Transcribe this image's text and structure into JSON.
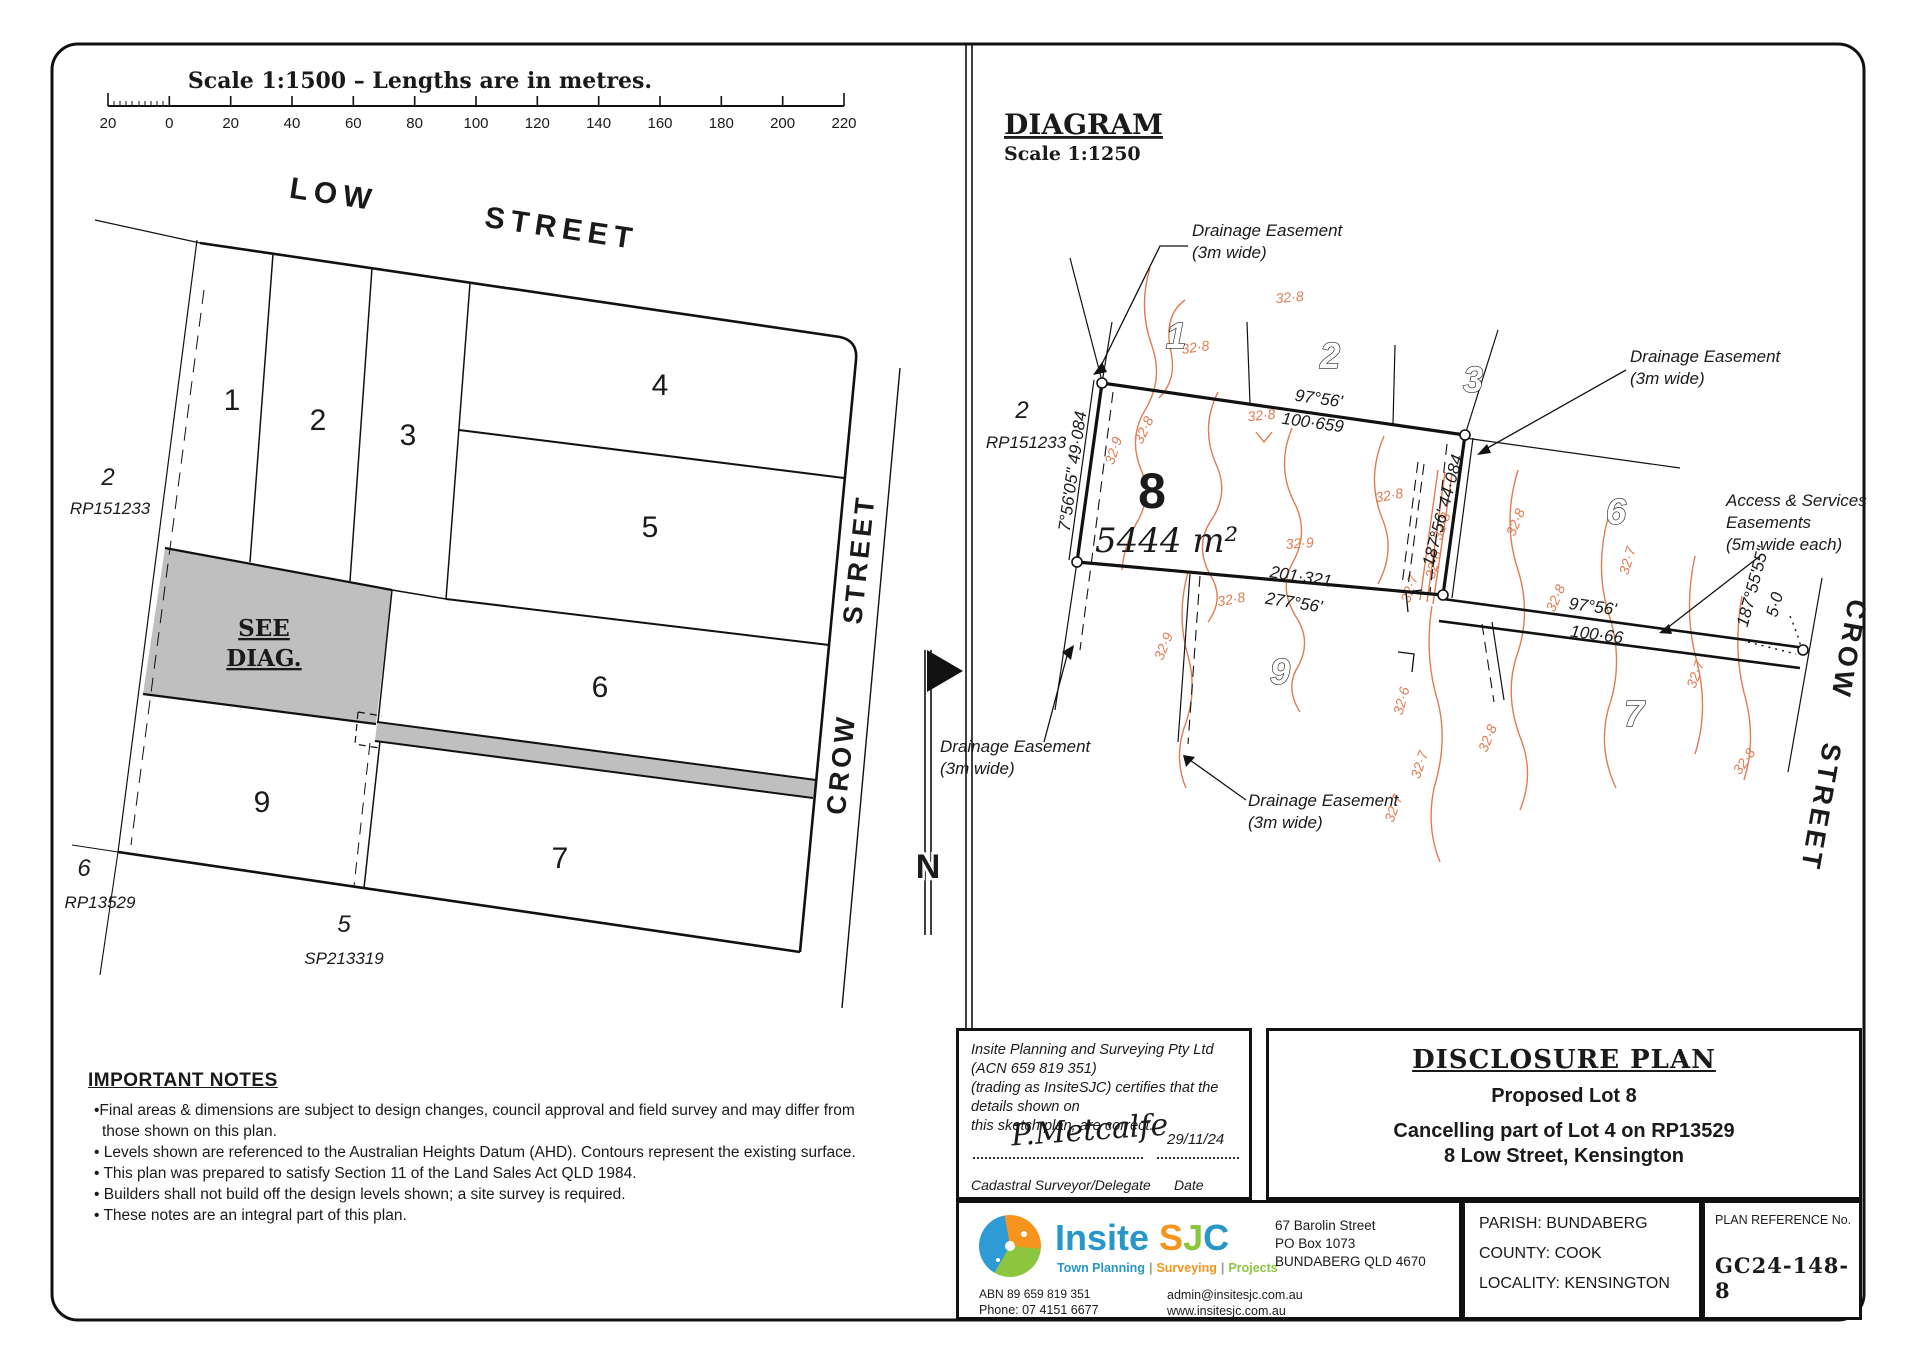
{
  "scale_bar": {
    "title": "Scale 1:1500 – Lengths are in metres.",
    "ticks": [
      "20",
      "0",
      "20",
      "40",
      "60",
      "80",
      "100",
      "120",
      "140",
      "160",
      "180",
      "200",
      "220"
    ]
  },
  "overview": {
    "low_street": {
      "w1": "LOW",
      "w2": "STREET"
    },
    "crow_street": {
      "w1": "CROW",
      "w2": "STREET"
    },
    "lots": {
      "l1": "1",
      "l2": "2",
      "l3": "3",
      "l4": "4",
      "l5": "5",
      "l6": "6",
      "l7": "7",
      "l9": "9"
    },
    "see_diag": {
      "l1": "SEE",
      "l2": "DIAG."
    },
    "adj_w": {
      "lot": "2",
      "plan": "RP151233"
    },
    "adj_sw": {
      "lot": "6",
      "plan": "RP13529"
    },
    "adj_s": {
      "lot": "5",
      "plan": "SP213319"
    },
    "north": "N"
  },
  "diagram": {
    "title": "DIAGRAM",
    "scale": "Scale 1:1250",
    "lot8": {
      "number": "8",
      "area": "5444 m²"
    },
    "adj": {
      "lot": "2",
      "plan": "RP151233"
    },
    "adj_lots": {
      "n1": "1",
      "n2": "2",
      "n3": "3",
      "n6": "6",
      "n9": "9",
      "n7": "7"
    },
    "crow_street": {
      "w1": "CROW",
      "w2": "STREET"
    },
    "bearings": {
      "west": "7°56'05\" 49·084",
      "top_b": "97°56'",
      "top_d": "100·659",
      "east": "187°56'  44·084",
      "south_d": "201·321",
      "south_b": "277°56'",
      "strip_b": "97°56'",
      "strip_d": "100·66",
      "crow_b": "187°55'55\"",
      "crow_d": "5·0"
    },
    "easements": {
      "d1a": "Drainage Easement",
      "d1b": "(3m wide)",
      "d2a": "Drainage Easement",
      "d2b": "(3m wide)",
      "d3a": "Drainage Easement",
      "d3b": "(3m wide)",
      "d4a": "Drainage Easement",
      "d4b": "(3m wide)",
      "acc1": "Access & Services",
      "acc2": "Easements",
      "acc3": "(5m wide each)"
    },
    "contours": [
      {
        "t": "32·8",
        "x": 1196,
        "y": 352,
        "r": -8
      },
      {
        "t": "32·8",
        "x": 1290,
        "y": 302,
        "r": -5
      },
      {
        "t": "32·9",
        "x": 1118,
        "y": 452,
        "r": -72
      },
      {
        "t": "32·8",
        "x": 1262,
        "y": 420,
        "r": -6
      },
      {
        "t": "32·8",
        "x": 1148,
        "y": 432,
        "r": -65
      },
      {
        "t": "32·9",
        "x": 1300,
        "y": 548,
        "r": -4
      },
      {
        "t": "32·8",
        "x": 1232,
        "y": 604,
        "r": -10
      },
      {
        "t": "32·9",
        "x": 1168,
        "y": 648,
        "r": -68
      },
      {
        "t": "32·8",
        "x": 1390,
        "y": 500,
        "r": -10
      },
      {
        "t": "32·8",
        "x": 1446,
        "y": 528,
        "r": -70
      },
      {
        "t": "32·8",
        "x": 1520,
        "y": 524,
        "r": -68
      },
      {
        "t": "32·6",
        "x": 1438,
        "y": 566,
        "r": -75
      },
      {
        "t": "32·7",
        "x": 1414,
        "y": 590,
        "r": -72
      },
      {
        "t": "32·8",
        "x": 1560,
        "y": 600,
        "r": -66
      },
      {
        "t": "32·7",
        "x": 1632,
        "y": 562,
        "r": -74
      },
      {
        "t": "32·7",
        "x": 1700,
        "y": 676,
        "r": -70
      },
      {
        "t": "32·8",
        "x": 1748,
        "y": 764,
        "r": -55
      },
      {
        "t": "32·6",
        "x": 1406,
        "y": 702,
        "r": -75
      },
      {
        "t": "32·7",
        "x": 1424,
        "y": 766,
        "r": -72
      },
      {
        "t": "32·7",
        "x": 1398,
        "y": 810,
        "r": -70
      },
      {
        "t": "32·8",
        "x": 1492,
        "y": 740,
        "r": -68
      }
    ]
  },
  "notes": {
    "heading": "IMPORTANT NOTES",
    "items": [
      "•Final areas & dimensions are subject to design changes, council approval and field survey and may differ from those shown on this plan.",
      "• Levels shown are referenced to the Australian Heights Datum (AHD). Contours represent the existing surface.",
      "• This plan was prepared to satisfy Section 11 of the Land Sales Act QLD 1984.",
      "• Builders shall not build off the design levels shown; a site survey is required.",
      "• These notes are an integral part of this plan."
    ]
  },
  "certification": {
    "line1": "Insite Planning and Surveying Pty Ltd (ACN 659 819 351)",
    "line2": "(trading as InsiteSJC) certifies that the details shown on",
    "line3": "this sketch plan, are correct.",
    "signature": "P.Metcalfe",
    "date": "29/11/24",
    "role": "Cadastral Surveyor/Delegate",
    "date_label": "Date"
  },
  "title_block": {
    "title": "DISCLOSURE PLAN",
    "line1": "Proposed Lot 8",
    "line2": "Cancelling part of Lot 4 on RP13529",
    "line3": "8 Low Street, Kensington"
  },
  "logo": {
    "name": "Insite",
    "sjc": "SJC",
    "tag1": "Town Planning",
    "tag2": "Surveying",
    "tag3": "Projects",
    "sep": "|",
    "abn": "ABN 89 659 819 351",
    "phone": "Phone: 07 4151 6677",
    "addr1": "67 Barolin Street",
    "addr2": "PO Box 1073",
    "addr3": "BUNDABERG QLD 4670",
    "email": "admin@insitesjc.com.au",
    "web": "www.insitesjc.com.au"
  },
  "admin": {
    "parish": "PARISH: BUNDABERG",
    "county": "COUNTY: COOK",
    "locality": "LOCALITY: KENSINGTON"
  },
  "reference": {
    "label": "PLAN REFERENCE No.",
    "value": "GC24-148-8"
  },
  "colors": {
    "contour": "#e07b52",
    "shade": "#bfbfbf",
    "logo_blue": "#2796c8",
    "logo_orange": "#f7941e",
    "logo_green": "#8cc63f"
  }
}
